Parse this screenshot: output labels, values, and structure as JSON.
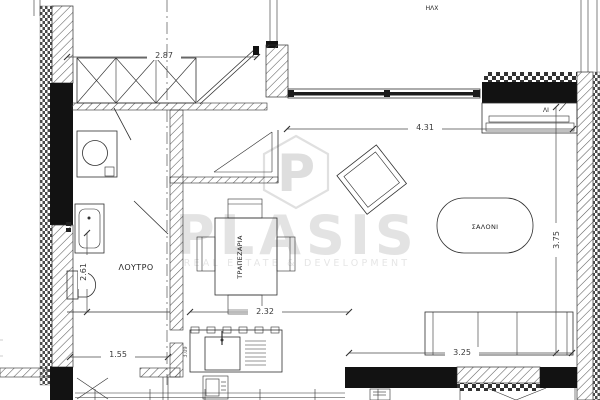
{
  "plan": {
    "watermark": {
      "logo_letter": "P",
      "brand": "PLASIS",
      "tagline": "REAL ESTATE & DEVELOPMENT"
    },
    "rooms": {
      "bathroom_label": "ΛΟΥΤΡΟ",
      "dining_label": "ΤΡΑΠΕΖΑΡΙΑ",
      "living_label": "ΣΑΛΟΝΙ"
    },
    "labels": {
      "top_note": "ΗΛΧ",
      "sill_note": "ΛΙ"
    },
    "dimensions": {
      "closet_width_m": "2.87",
      "living_width_m": "4.31",
      "living_depth_m": "3.75",
      "bathroom_depth_m": "2.61",
      "bathroom_width_m": "1.55",
      "kitchen_width_m": "2.32",
      "sofa_wall_m": "3.25",
      "wall_side_m": "3.09"
    },
    "colors": {
      "line": "#2f2f2f",
      "wall_fill": "#121212",
      "watermark": "#e3e3e3"
    }
  }
}
